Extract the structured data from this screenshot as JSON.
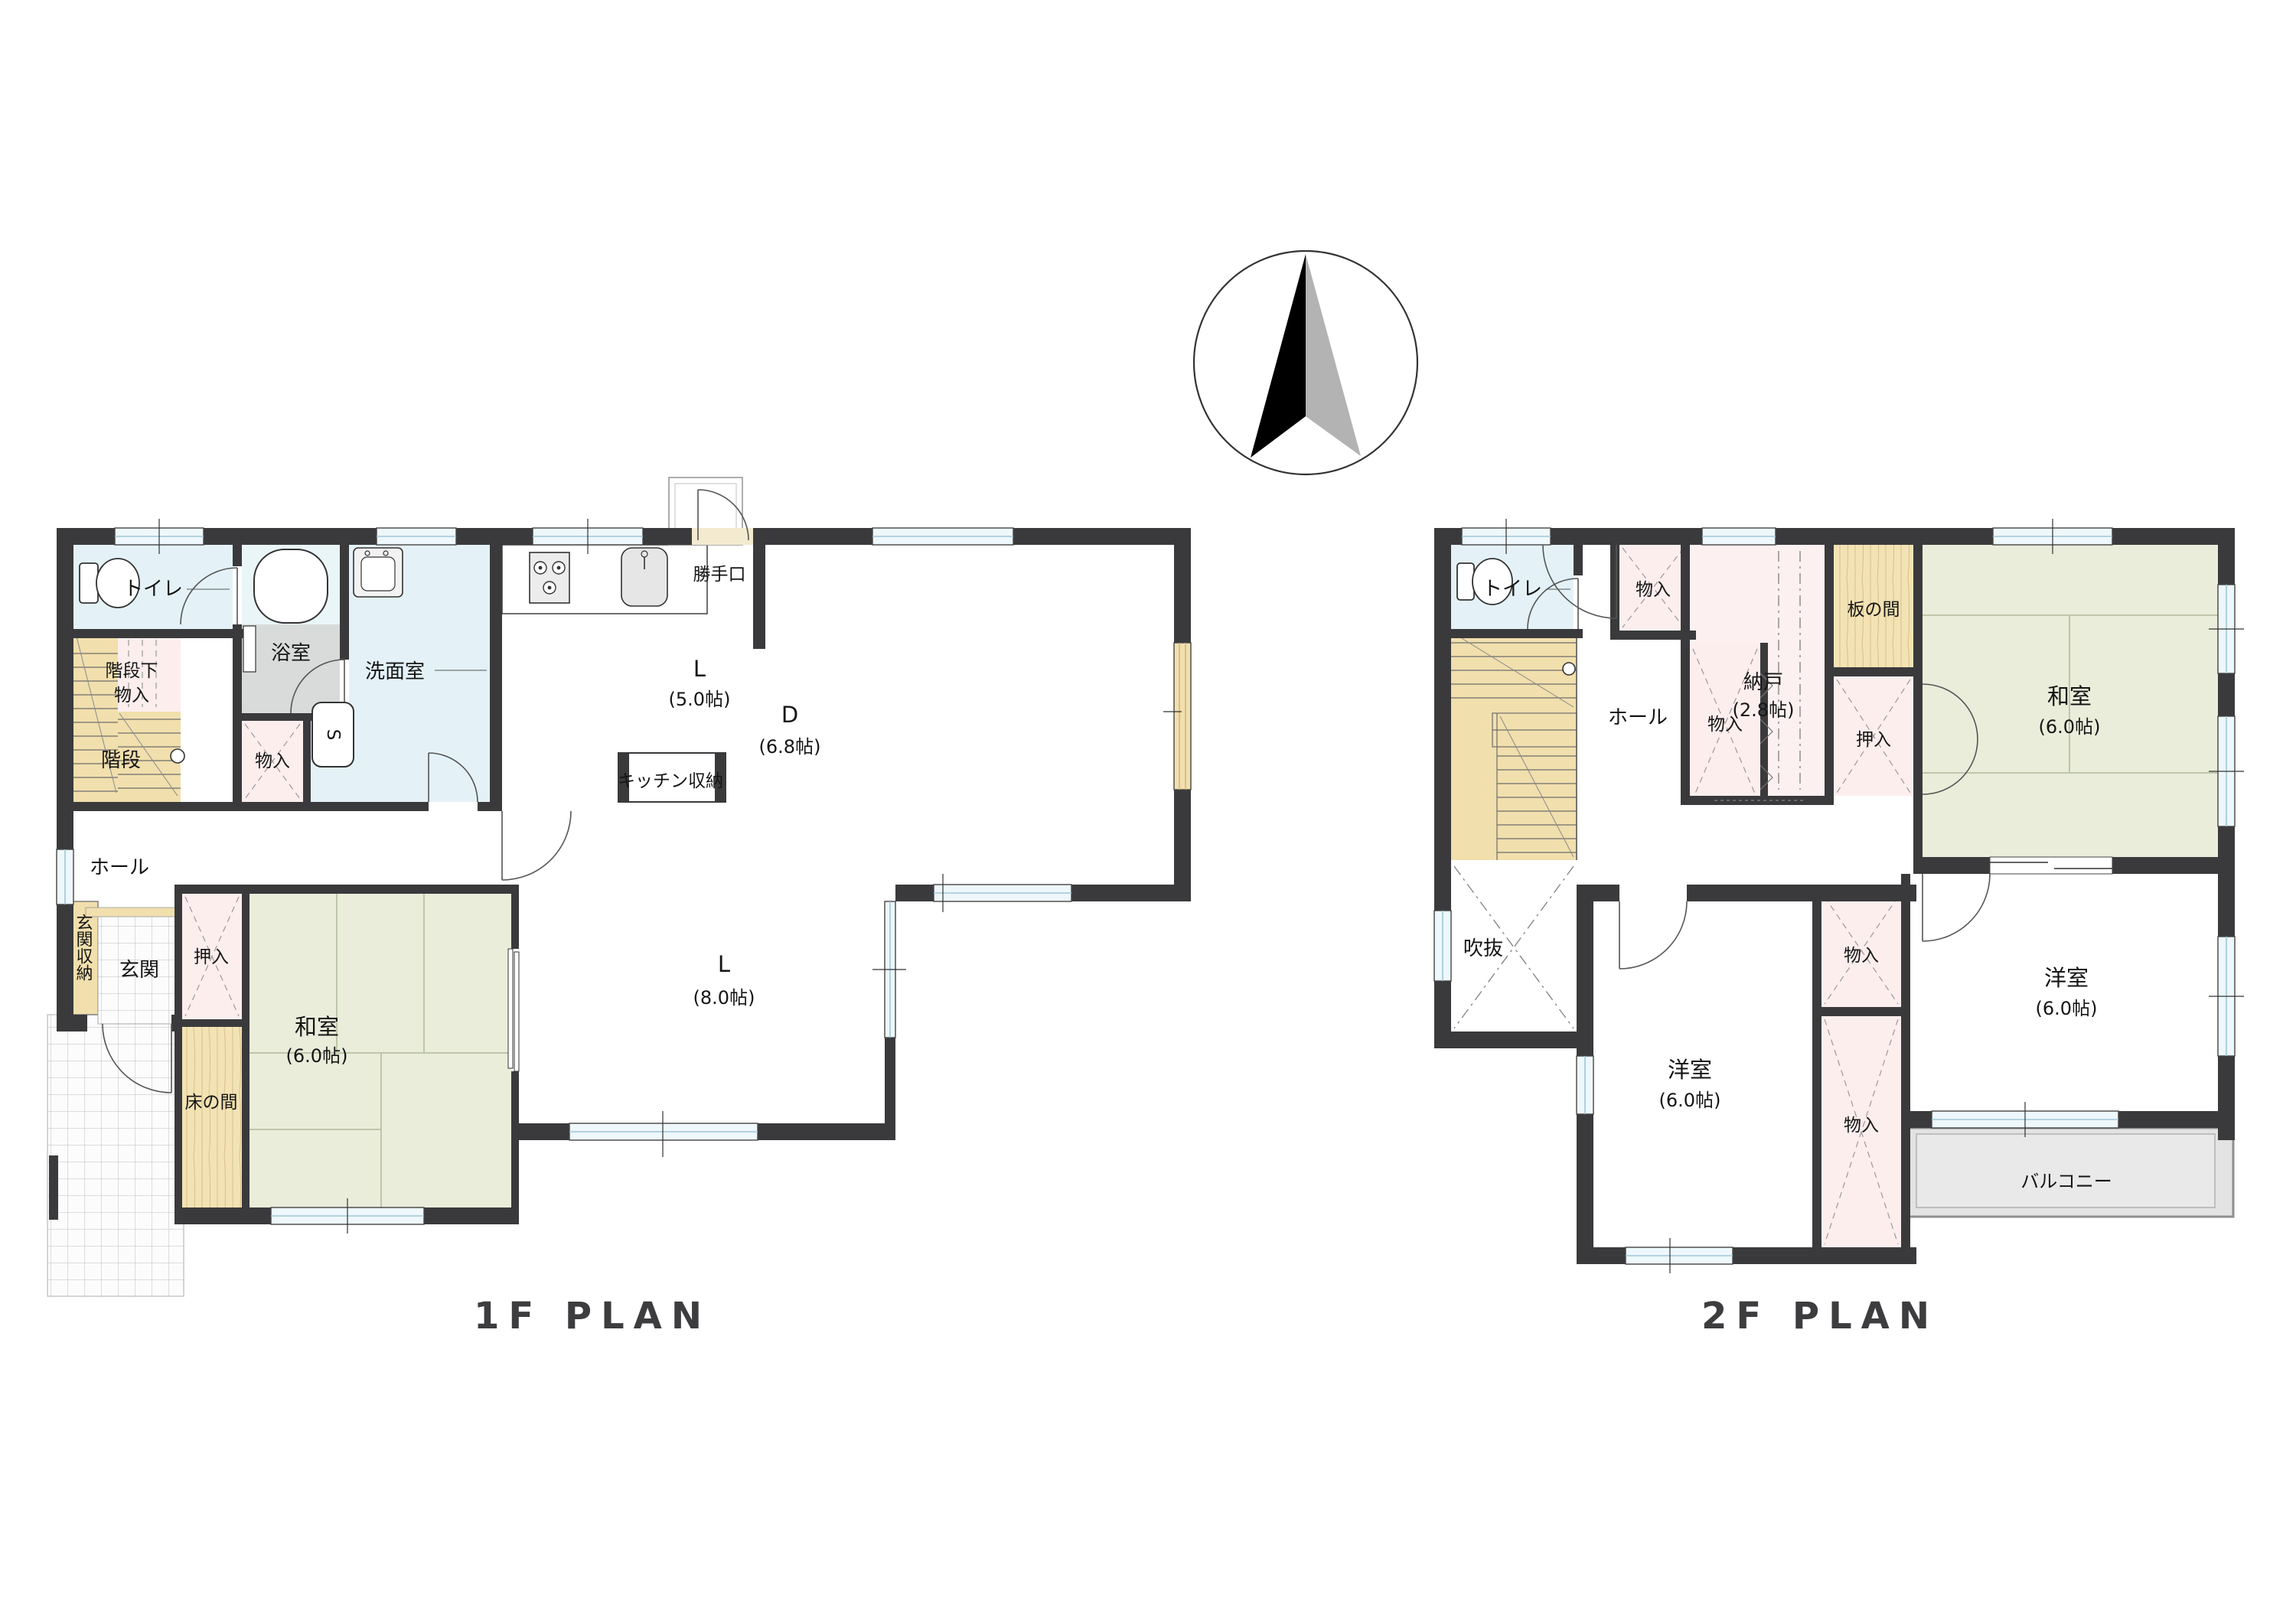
{
  "compass": {
    "type": "north-arrow"
  },
  "colors": {
    "wall": "#3a3a3c",
    "water_room": "#e4f2f7",
    "closet_pink": "#fdeeee",
    "storeroom_pink": "#fcf0f0",
    "tatami_green": "#e9edda",
    "wood_tan": "#f1dfad",
    "bath_tile": "#d9dbdb",
    "balcony_grey": "#e3e3e3",
    "title_grey": "#3d3d40"
  },
  "floor1": {
    "title": "1F PLAN",
    "rooms": {
      "toilet": "トイレ",
      "understair1": "階段下",
      "understair2": "物入",
      "stairs": "階段",
      "hall": "ホール",
      "entrance_storage": "玄関収納",
      "entrance": "玄関",
      "closet": "押入",
      "tokonoma": "床の間",
      "washitsu": "和室",
      "washitsu_size": "(6.0帖)",
      "bath": "浴室",
      "washroom": "洗面室",
      "storage": "物入",
      "washer_s": "S",
      "kitchen_l": "L",
      "kitchen_size": "(5.0帖)",
      "kitchen_storage": "キッチン収納",
      "back_door": "勝手口",
      "dining_d": "D",
      "dining_size": "(6.8帖)",
      "living_l": "L",
      "living_size": "(8.0帖)"
    }
  },
  "floor2": {
    "title": "2F PLAN",
    "rooms": {
      "toilet": "トイレ",
      "storage_top": "物入",
      "hall": "ホール",
      "storage_mid": "物入",
      "storeroom": "納戸",
      "storeroom_size": "(2.8帖)",
      "itanoma": "板の間",
      "oshiire": "押入",
      "washitsu": "和室",
      "washitsu_size": "(6.0帖)",
      "void": "吹抜",
      "western_left": "洋室",
      "western_left_size": "(6.0帖)",
      "storage_upper": "物入",
      "storage_lower": "物入",
      "western_right": "洋室",
      "western_right_size": "(6.0帖)",
      "balcony": "バルコニー"
    }
  }
}
